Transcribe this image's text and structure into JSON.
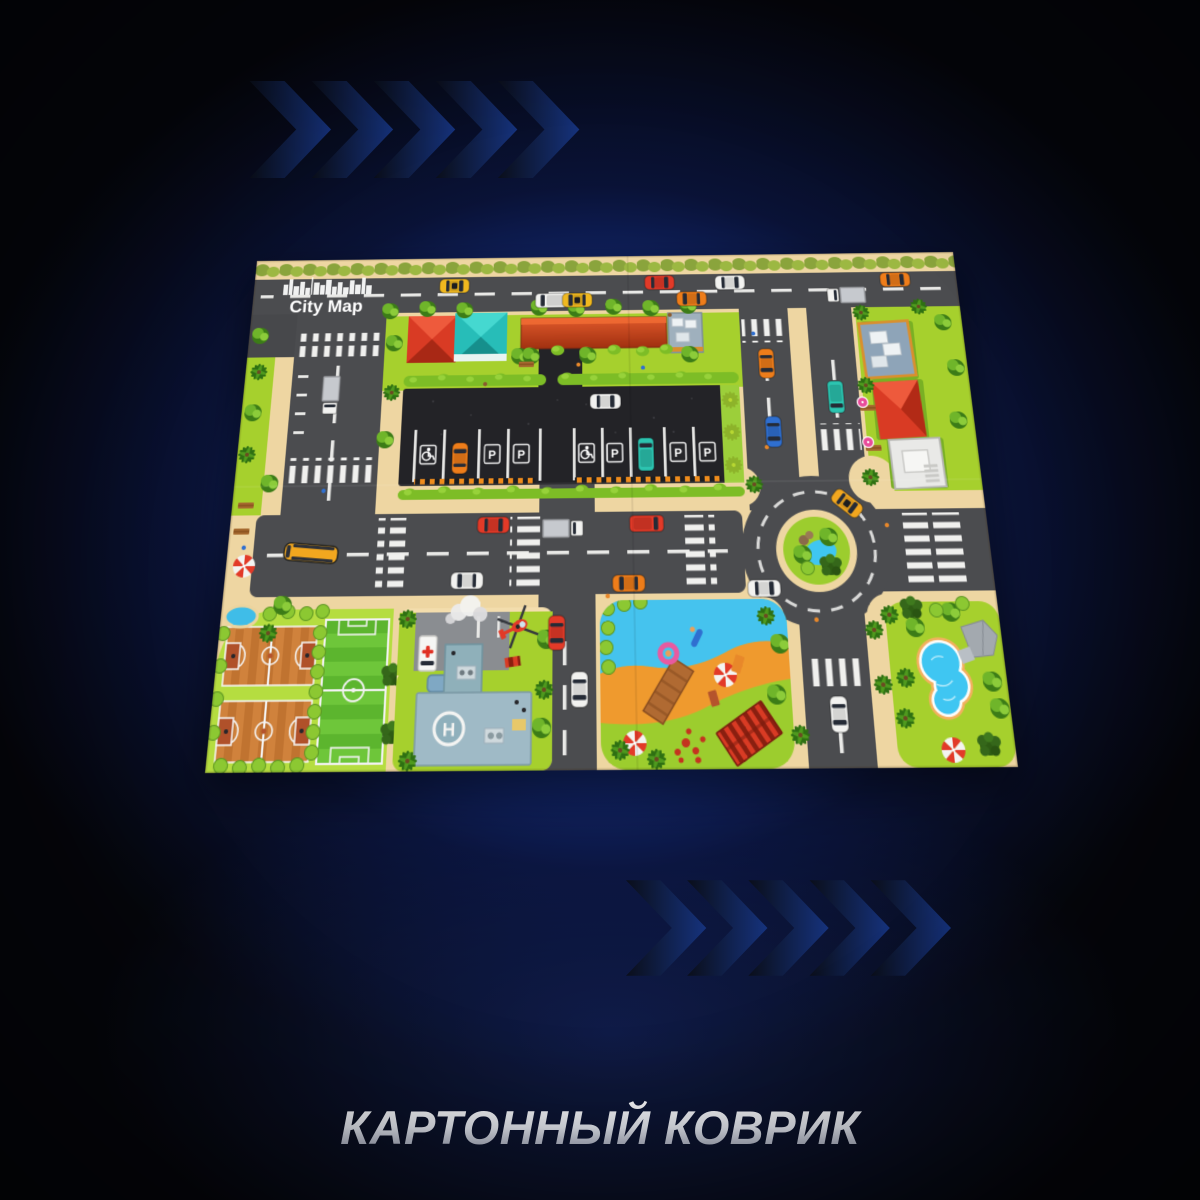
{
  "banner": {
    "text": "КАРТОННЫЙ КОВРИК",
    "gradient": {
      "top": "#fdfdfe",
      "mid": "#dfe2ea",
      "bottom": "#8f95a8"
    }
  },
  "background": {
    "glow": "#214ecd",
    "mid": "#17379e",
    "dark": "#05060b"
  },
  "chevrons": {
    "top_count": 5,
    "bottom_count": 5,
    "gradient": [
      "#0a0e1a",
      "#16337e",
      "#1f57c0",
      "#2f8fdc",
      "#3cb8f0"
    ]
  },
  "mat": {
    "logo": {
      "title": "City Map"
    },
    "helipad_letter": "H",
    "parking": {
      "sign_letter": "P",
      "signs": [
        {
          "x": 197,
          "glyph": "wheelchair-icon"
        },
        {
          "x": 263,
          "glyph": "P"
        },
        {
          "x": 293,
          "glyph": "P"
        },
        {
          "x": 360,
          "glyph": "wheelchair-icon"
        },
        {
          "x": 389,
          "glyph": "P"
        },
        {
          "x": 454,
          "glyph": "P"
        },
        {
          "x": 484,
          "glyph": "P"
        }
      ]
    },
    "features": [
      "top-road",
      "left-road",
      "main-road",
      "roundabout-with-pond",
      "central-parking-lot",
      "mall-strip-building",
      "red-roof-house",
      "teal-roof-house",
      "gray-rooftop-building",
      "skylight-building",
      "white-building",
      "basketball-courts",
      "soccer-field",
      "hospital-with-helipad",
      "ambulance",
      "helicopter",
      "beach-playground-pond",
      "pier",
      "swimming-pool-garden",
      "school-bus",
      "beach-umbrellas",
      "palm-trees"
    ],
    "palette": {
      "grass": "#a6d02d",
      "grass_light": "#b5dd40",
      "sand": "#eed6a2",
      "road": "#4b4c4f",
      "asphalt": "#232327",
      "marking": "#f0f0ee",
      "water": "#45c3ee",
      "pool": "#3fc6f2",
      "roof_red": "#d93b24",
      "roof_teal": "#27bdb8",
      "beach_sand": "#ef9a2e",
      "court": "#cd7a35"
    },
    "vehicles": [
      {
        "t": "taxi",
        "c": "#f0b81f",
        "x": 218,
        "y": 32,
        "r": 0
      },
      {
        "t": "van",
        "c": "#f2f2f0",
        "x": 323,
        "y": 50,
        "r": 180
      },
      {
        "t": "taxi",
        "c": "#f0b81f",
        "x": 351,
        "y": 50,
        "r": 180
      },
      {
        "t": "car",
        "c": "#e23a28",
        "x": 440,
        "y": 31,
        "r": 0
      },
      {
        "t": "car",
        "c": "#ee7d1a",
        "x": 474,
        "y": 50,
        "r": 180
      },
      {
        "t": "car",
        "c": "#f2f2f0",
        "x": 516,
        "y": 32,
        "r": 0
      },
      {
        "t": "truck",
        "c": "#f2f2f0",
        "x": 640,
        "y": 48,
        "r": 180
      },
      {
        "t": "car",
        "c": "#ee7d1a",
        "x": 694,
        "y": 31,
        "r": 0
      },
      {
        "t": "truck",
        "c": "#f2f2f0",
        "x": 92,
        "y": 152,
        "r": 90
      },
      {
        "t": "bus",
        "c": "#f2a71f",
        "x": 84,
        "y": 314,
        "r": 185
      },
      {
        "t": "car",
        "c": "#e23a28",
        "x": 266,
        "y": 288,
        "r": 0
      },
      {
        "t": "truck",
        "c": "#f2f2f0",
        "x": 336,
        "y": 292,
        "r": 0
      },
      {
        "t": "car",
        "c": "#f2f2f0",
        "x": 241,
        "y": 342,
        "r": 180
      },
      {
        "t": "van",
        "c": "#e23a28",
        "x": 420,
        "y": 288,
        "r": 0
      },
      {
        "t": "car",
        "c": "#ee7d1a",
        "x": 401,
        "y": 346,
        "r": 180
      },
      {
        "t": "car",
        "c": "#ee7d1a",
        "x": 550,
        "y": 123,
        "r": 90
      },
      {
        "t": "car",
        "c": "#2f6fd0",
        "x": 553,
        "y": 196,
        "r": 90
      },
      {
        "t": "van",
        "c": "#2cc4b0",
        "x": 620,
        "y": 160,
        "r": 90
      },
      {
        "t": "taxi",
        "c": "#f2a71f",
        "x": 622,
        "y": 270,
        "r": 40
      },
      {
        "t": "car",
        "c": "#f2f2f0",
        "x": 534,
        "y": 352,
        "r": 0
      },
      {
        "t": "car",
        "c": "#e23a28",
        "x": 330,
        "y": 392,
        "r": 90
      },
      {
        "t": "car",
        "c": "#f2f2f0",
        "x": 352,
        "y": 444,
        "r": 90
      },
      {
        "t": "car",
        "c": "#f2f2f0",
        "x": 598,
        "y": 468,
        "r": 90
      },
      {
        "t": "car",
        "c": "#ee7d1a",
        "x": 230,
        "y": 220,
        "r": -90
      },
      {
        "t": "van",
        "c": "#2cc4b0",
        "x": 421,
        "y": 218,
        "r": -90
      },
      {
        "t": "car",
        "c": "#f2f2f0",
        "x": 380,
        "y": 162,
        "r": 0
      },
      {
        "t": "ambulance",
        "c": "#ffffff",
        "x": 205,
        "y": 410,
        "r": 90
      },
      {
        "t": "heli",
        "c": "#e23a28",
        "x": 292,
        "y": 386,
        "r": -25
      }
    ]
  }
}
